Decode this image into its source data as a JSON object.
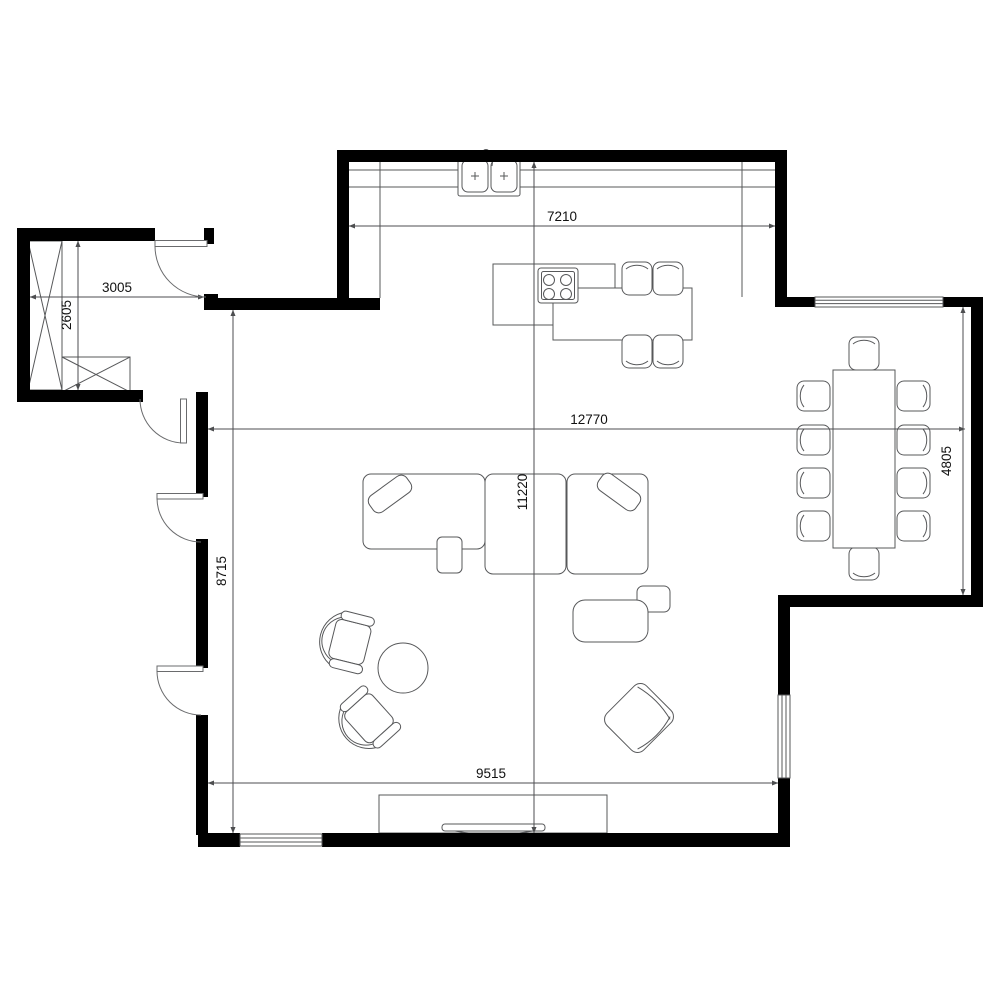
{
  "document": {
    "type": "architectural-floor-plan",
    "units": "mm"
  },
  "dims": {
    "kitchen_width_mm": "7210",
    "hall_width_mm": "3005",
    "hall_depth_mm": "2605",
    "total_width_mm": "12770",
    "total_depth_mm": "11220",
    "dining_depth_mm": "4805",
    "living_depth_mm": "8715",
    "living_width_mm": "9515"
  },
  "colors": {
    "wall": "#000000",
    "furniture_line": "#57585a",
    "dimension_line": "#4d4e50",
    "text": "#111111",
    "background": "#ffffff"
  },
  "furniture_legend": {
    "wardrobe-icon": "tall cabinet with X cross",
    "bench-icon": "low cabinet with X cross",
    "sink-icon": "double-bowl kitchen sink with faucet",
    "stove-icon": "4-burner cooktop",
    "island-icon": "kitchen island with table extension",
    "stool-icon": "seat with curved back",
    "dining-table-icon": "rectangular 10-seat table",
    "bed-icon": "bed / lounger with cushion",
    "armchair-icon": "tub armchair",
    "accent-chair-icon": "rotated lounge chair",
    "ottoman-icon": "rounded ottoman",
    "coffee-table-icon": "round table",
    "tv-icon": "flat screen on media stand",
    "door-icon": "door leaf with swing arc",
    "window-icon": "double-line window in wall"
  }
}
